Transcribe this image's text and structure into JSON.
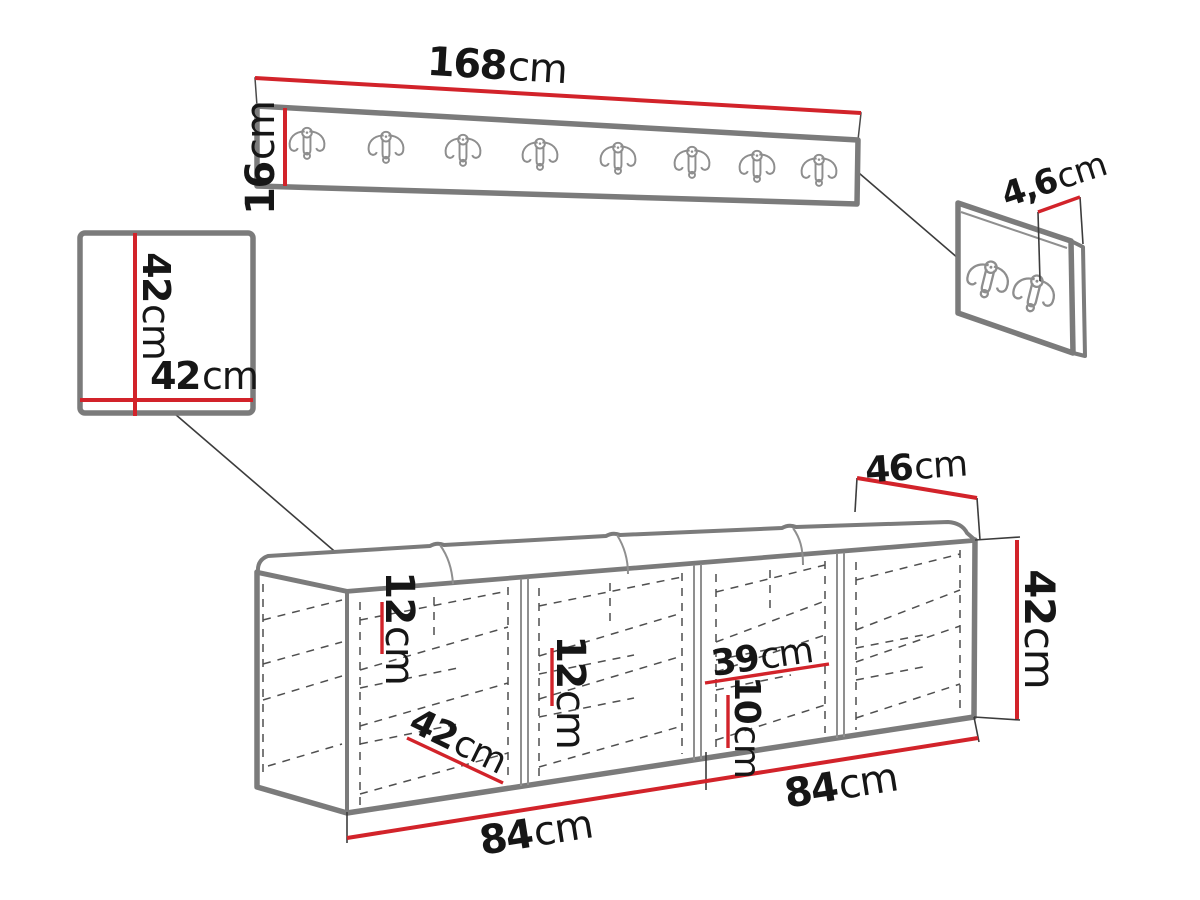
{
  "title": "Hallway furniture set — dimension drawing",
  "units": "cm",
  "palette": {
    "dimension_red": "#d2232a",
    "outline_gray": "#7b7b7b",
    "dash_gray": "#4f4f4f",
    "text_black": "#161616"
  },
  "parts": {
    "coat_rack": {
      "name": "wall coat rack panel",
      "hook_count": 8,
      "width": {
        "value": "168",
        "unit": "cm"
      },
      "height": {
        "value": "16",
        "unit": "cm"
      }
    },
    "wall_panel": {
      "name": "square wall panel",
      "height": {
        "value": "42",
        "unit": "cm"
      },
      "width": {
        "value": "42",
        "unit": "cm"
      }
    },
    "hook_panel": {
      "name": "small hook panel",
      "hook_count": 2,
      "thickness": {
        "value": "4,6",
        "unit": "cm"
      }
    },
    "bench": {
      "name": "storage bench with cushion",
      "compartments": 4,
      "depth": {
        "value": "46",
        "unit": "cm"
      },
      "height": {
        "value": "42",
        "unit": "cm"
      },
      "shelf_gap_1": {
        "value": "12",
        "unit": "cm"
      },
      "shelf_gap_2": {
        "value": "12",
        "unit": "cm"
      },
      "compartment_width": {
        "value": "39",
        "unit": "cm"
      },
      "shelf_gap_3": {
        "value": "10",
        "unit": "cm"
      },
      "inner_depth": {
        "value": "42",
        "unit": "cm"
      },
      "left_span": {
        "value": "84",
        "unit": "cm"
      },
      "right_span": {
        "value": "84",
        "unit": "cm"
      }
    }
  }
}
